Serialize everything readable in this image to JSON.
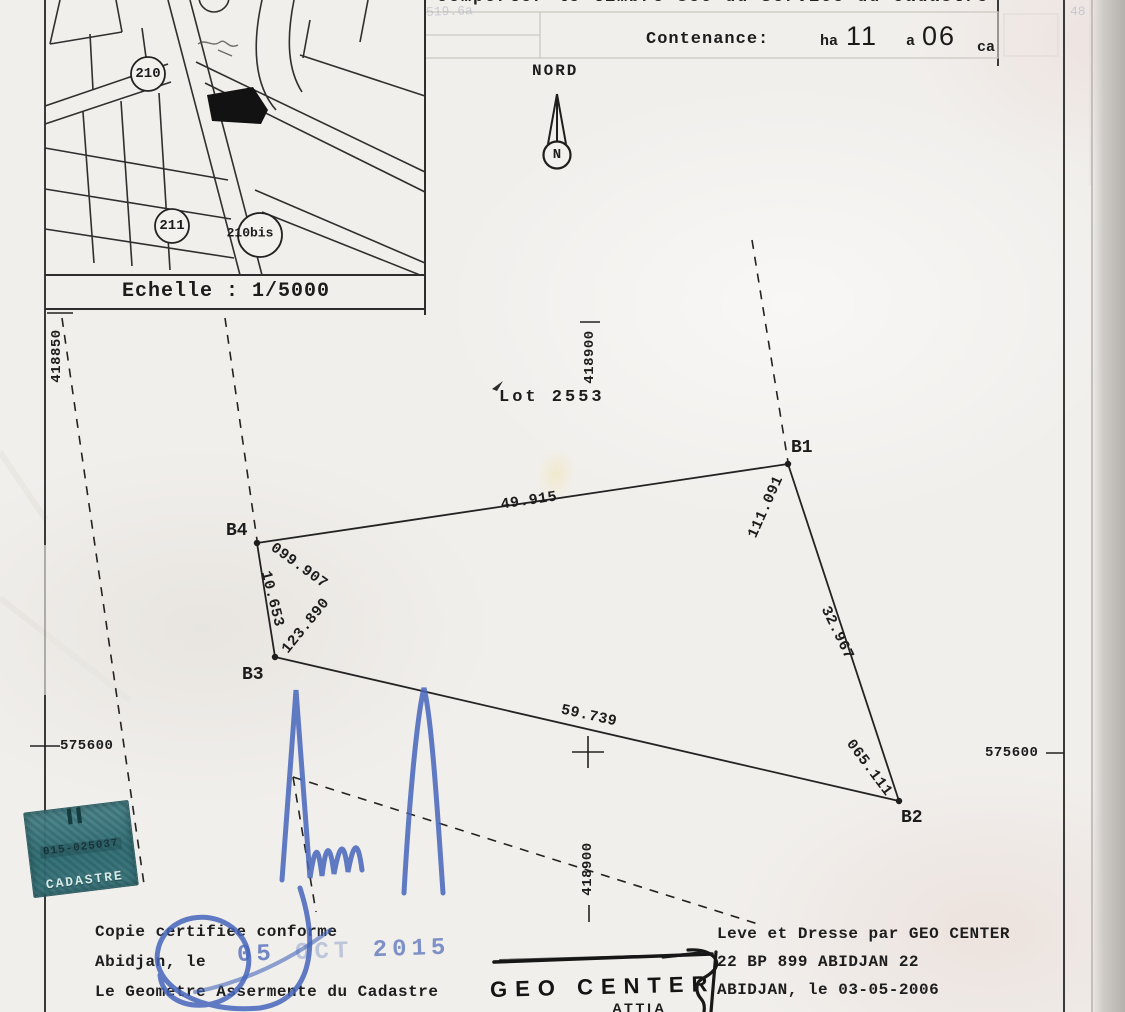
{
  "header": {
    "top_note": "comporter le timbre sec du Service du Cadastre",
    "faint_marks": {
      "left": "519.6a",
      "right": "48"
    },
    "contenance": {
      "label": "Contenance:",
      "fields": [
        {
          "unit": "ha",
          "value": "11"
        },
        {
          "unit": "a",
          "value": "06"
        },
        {
          "unit": "ca",
          "value": ""
        }
      ]
    }
  },
  "inset_map": {
    "scale_label": "Echelle : 1/5000",
    "parcel_labels": [
      {
        "label": "210"
      },
      {
        "label": "211"
      },
      {
        "label": "210bis"
      }
    ]
  },
  "compass": {
    "label": "NORD",
    "letter": "N"
  },
  "survey": {
    "lot_label": "Lot 2553",
    "vertices": [
      {
        "name": "B1"
      },
      {
        "name": "B2"
      },
      {
        "name": "B3"
      },
      {
        "name": "B4"
      }
    ],
    "dimensions": [
      {
        "value": "49.915"
      },
      {
        "value": "111.091"
      },
      {
        "value": "32.967"
      },
      {
        "value": "065.111"
      },
      {
        "value": "59.739"
      },
      {
        "value": "10.653"
      },
      {
        "value": "099.907"
      },
      {
        "value": "123.890"
      }
    ],
    "grid_labels": {
      "north_west": "418850",
      "north_mid_top": "418900",
      "north_mid_bottom": "418900",
      "east_left": "575600",
      "east_right": "575600"
    }
  },
  "stamps": {
    "cadastre_stamp": {
      "number": "015-025037",
      "caption": "CADASTRE"
    },
    "date_stamp": {
      "day": "05",
      "month": "OCT",
      "year": "2015"
    },
    "surveyor_stamp": {
      "name": "GEO CENTER",
      "sub": "ATTIA"
    }
  },
  "footer": {
    "left": {
      "line1": "Copie certifiee conforme",
      "line2": "Abidjan, le",
      "line3": "Le Geometre Assermente du Cadastre"
    },
    "right": {
      "line1": "Leve et Dresse par GEO CENTER",
      "line2": "22 BP 899 ABIDJAN 22",
      "line3": "ABIDJAN, le 03-05-2006"
    }
  }
}
